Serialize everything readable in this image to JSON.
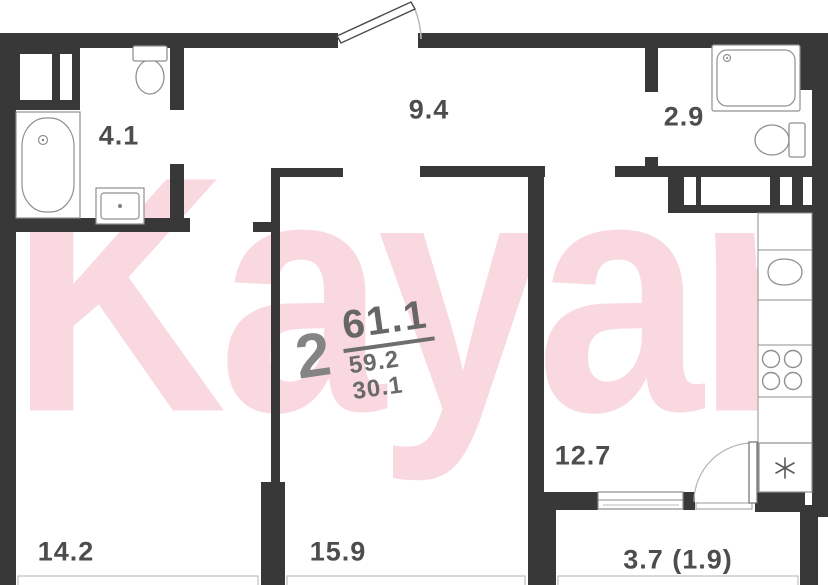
{
  "watermark": "Kayan",
  "unit": {
    "rooms_count": "2",
    "area_total": "61.1",
    "area_line2": "59.2",
    "area_line3": "30.1"
  },
  "labels": {
    "bathroom": "4.1",
    "hallway": "9.4",
    "shower_room": "2.9",
    "room_left": "14.2",
    "room_middle": "15.9",
    "kitchen": "12.7",
    "balcony": "3.7 (1.9)"
  },
  "colors": {
    "wall": "#383838",
    "fixture_stroke": "#909090",
    "label_text": "#4d4d4d",
    "unit_text": "#6e6e6e",
    "watermark_pink": "#f9d8e0"
  }
}
